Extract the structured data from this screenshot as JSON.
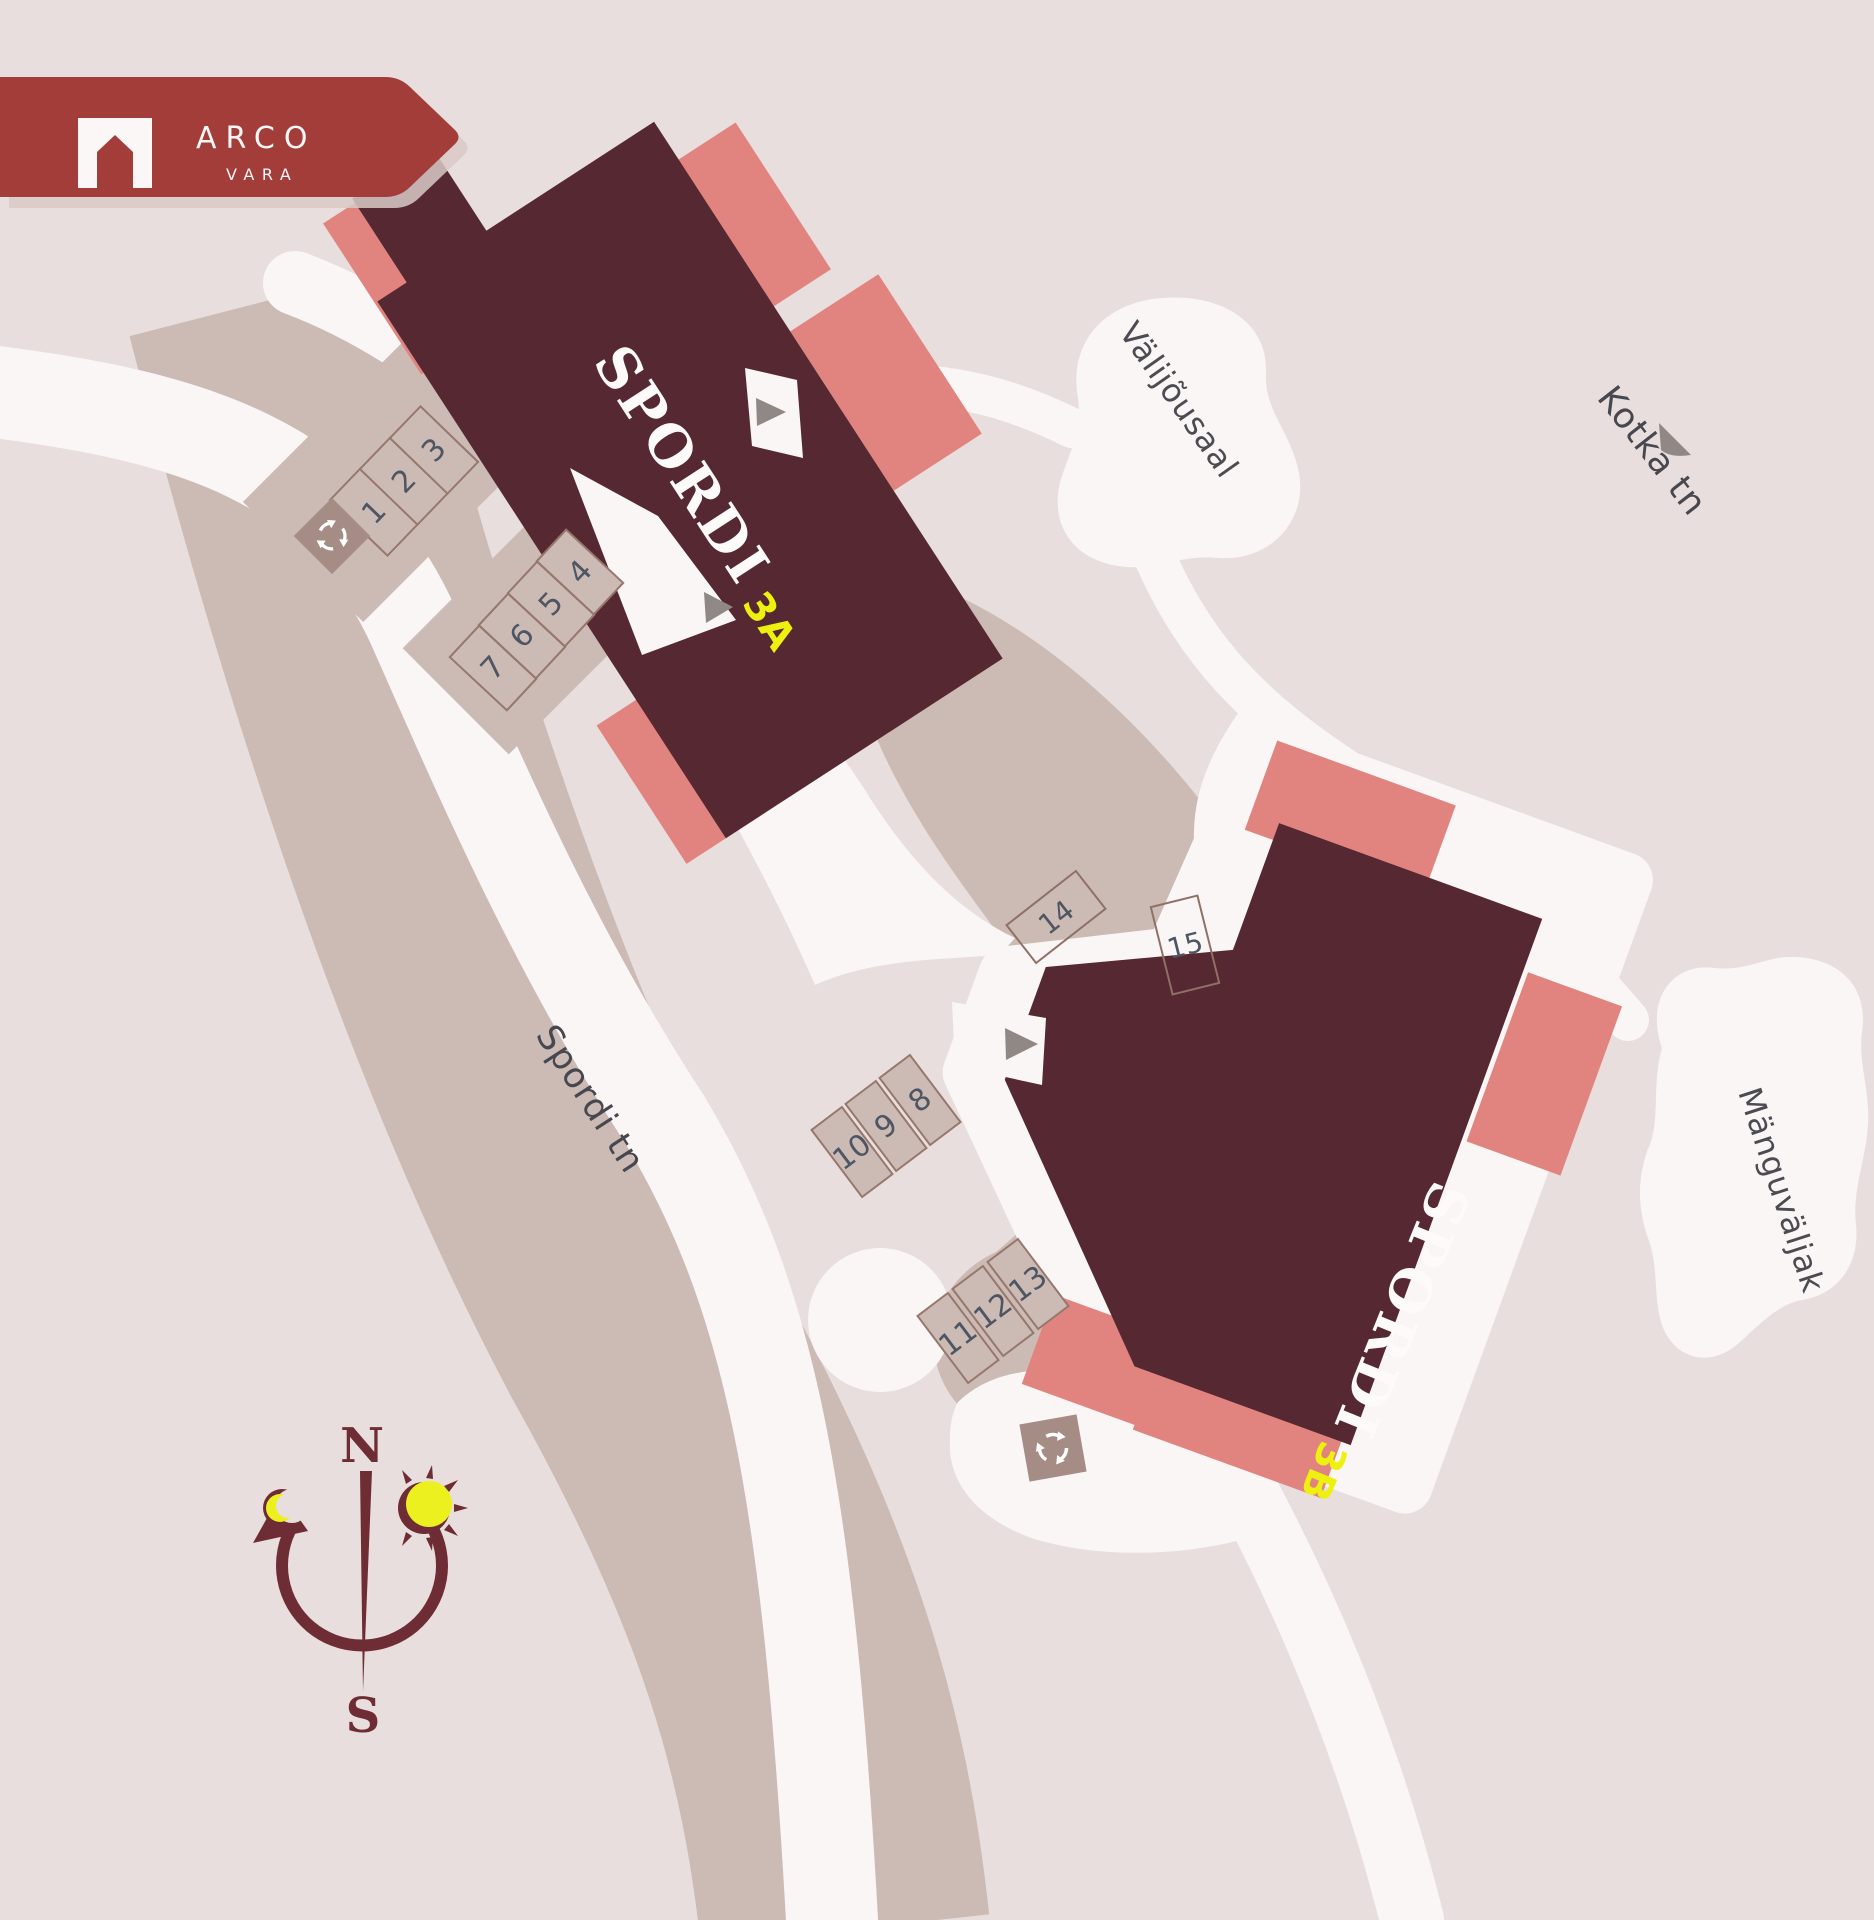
{
  "logo": {
    "brand": "ARCO",
    "sub": "VARA"
  },
  "buildings": [
    {
      "name": "SPORDI",
      "unit": "3A"
    },
    {
      "name": "SPORDI",
      "unit": "3B"
    }
  ],
  "streets": {
    "main": "Spordi tn",
    "cross": "Kotka tn"
  },
  "areas": {
    "outdoor_gym": "Välijõusaal",
    "playground": "Mänguväljak"
  },
  "parking": {
    "spots": [
      {
        "label": "1"
      },
      {
        "label": "2"
      },
      {
        "label": "3"
      },
      {
        "label": "4"
      },
      {
        "label": "5"
      },
      {
        "label": "6"
      },
      {
        "label": "7"
      },
      {
        "label": "8"
      },
      {
        "label": "9"
      },
      {
        "label": "10"
      },
      {
        "label": "11"
      },
      {
        "label": "12"
      },
      {
        "label": "13"
      },
      {
        "label": "14"
      },
      {
        "label": "15"
      }
    ]
  },
  "compass": {
    "north": "N",
    "south": "S"
  },
  "colors": {
    "background": "#e8dedd",
    "building": "#552832",
    "accent_salmon": "#e18480",
    "brand_red": "#a23d3a",
    "path_white": "#faf6f6",
    "pavement": "#ccbbb5",
    "number_text": "#4e5663",
    "label_text": "#47474f",
    "unit_yellow": "#eef00f",
    "compass": "#6e2d34"
  }
}
